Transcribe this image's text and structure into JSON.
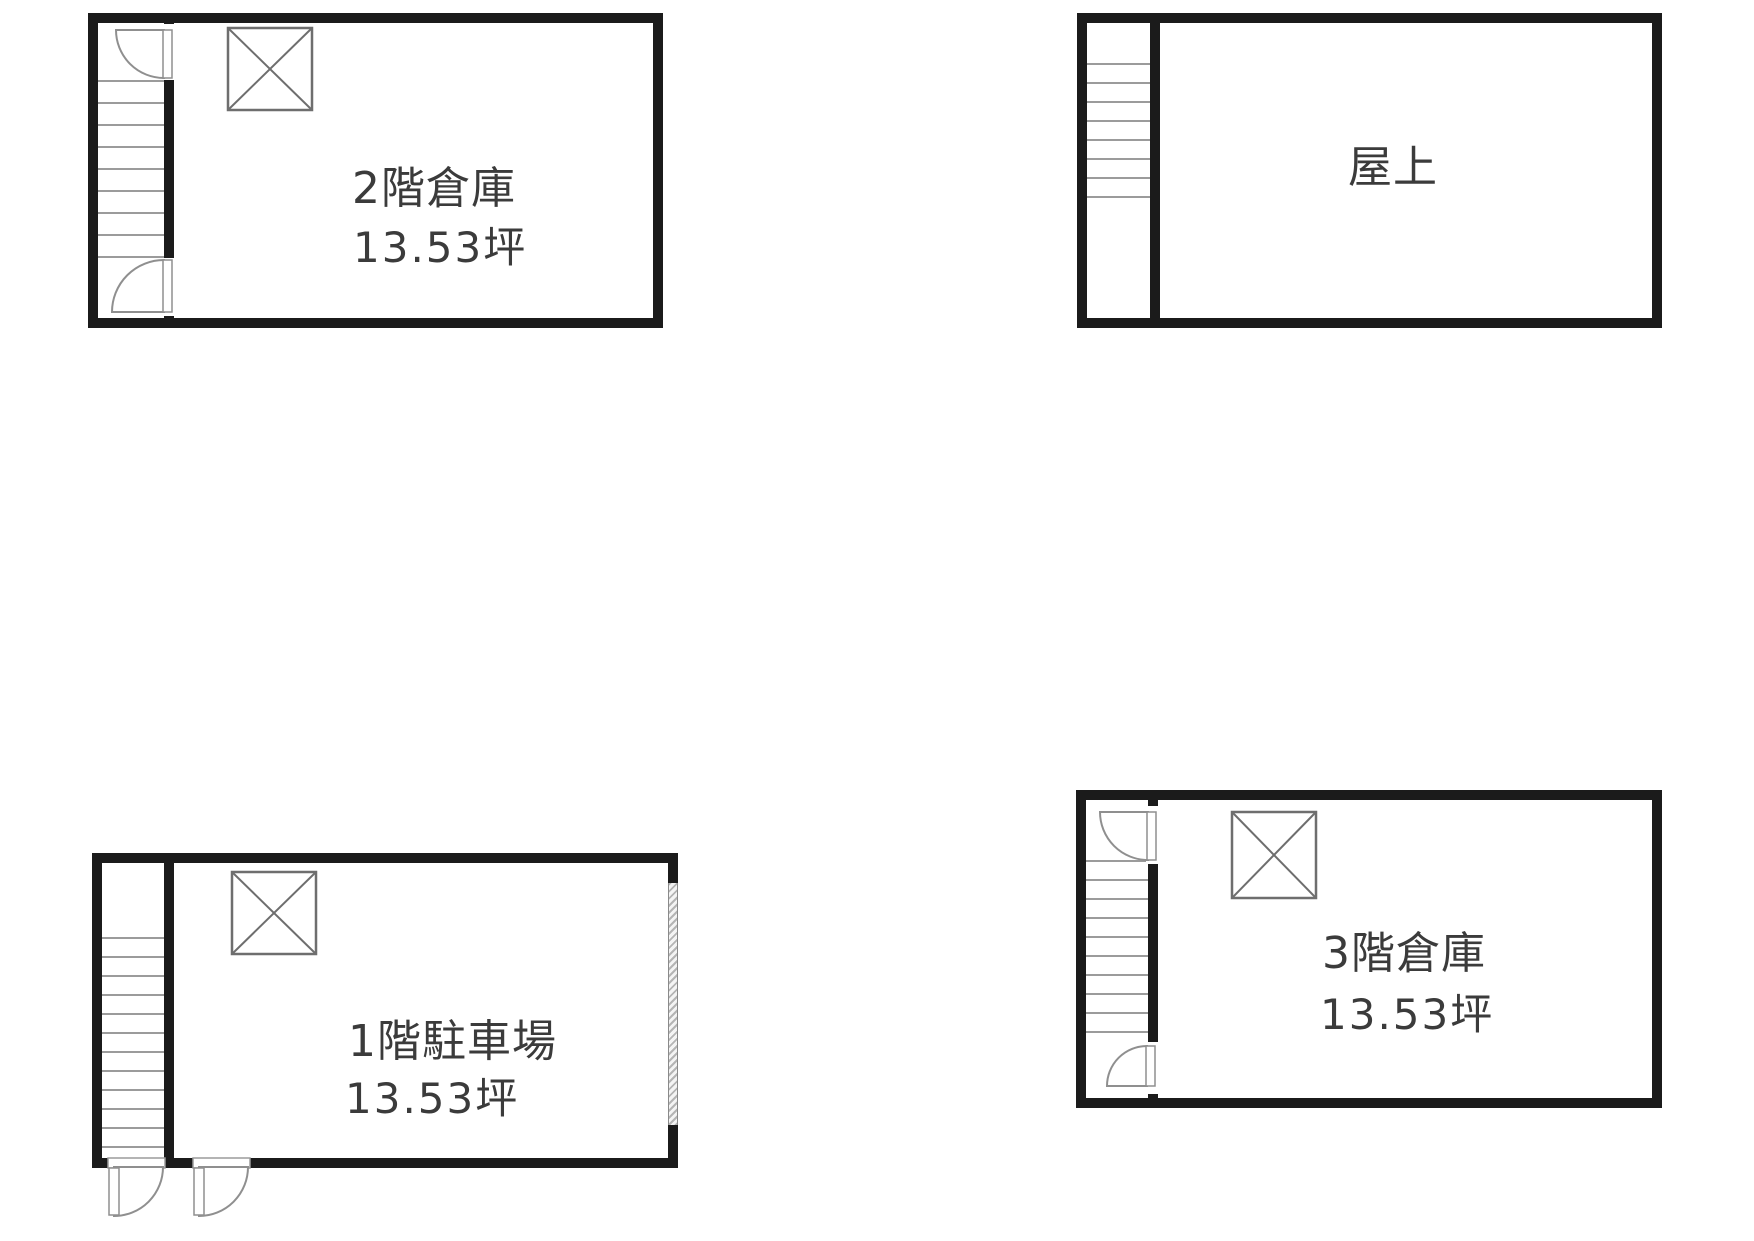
{
  "sheet": {
    "type": "building-floor-plans",
    "floor_count_shown": 4,
    "area_unit": "坪"
  },
  "plans": [
    {
      "id": "second-floor-warehouse",
      "room_label": "2階倉庫",
      "area_label": "13.53坪",
      "features": [
        "staircase",
        "swing-door",
        "swing-door",
        "elevator-shaft"
      ]
    },
    {
      "id": "rooftop",
      "room_label": "屋上",
      "area_label": null,
      "features": [
        "staircase"
      ]
    },
    {
      "id": "first-floor-parking",
      "room_label": "1階駐車場",
      "area_label": "13.53坪",
      "features": [
        "staircase",
        "swing-door",
        "swing-door",
        "elevator-shaft",
        "shutter-gate"
      ]
    },
    {
      "id": "third-floor-warehouse",
      "room_label": "3階倉庫",
      "area_label": "13.53坪",
      "features": [
        "staircase",
        "swing-door",
        "swing-door",
        "elevator-shaft"
      ]
    }
  ],
  "colors": {
    "background": "#ffffff",
    "wall": "#1b1b1b",
    "text": "#3b3b3b",
    "stair_tread": "#9b9b9b",
    "door_outline": "#8f8f8f",
    "elevator_outline": "#6e6e6e",
    "shutter_hatch": "#b5b5b5"
  },
  "symbols": {
    "elevator-shaft-icon": "square-with-x",
    "door-swing-icon": "quarter-circle-arc",
    "stair-treads": "parallel-lines",
    "shutter-door": "diagonal-hatch-strip"
  }
}
